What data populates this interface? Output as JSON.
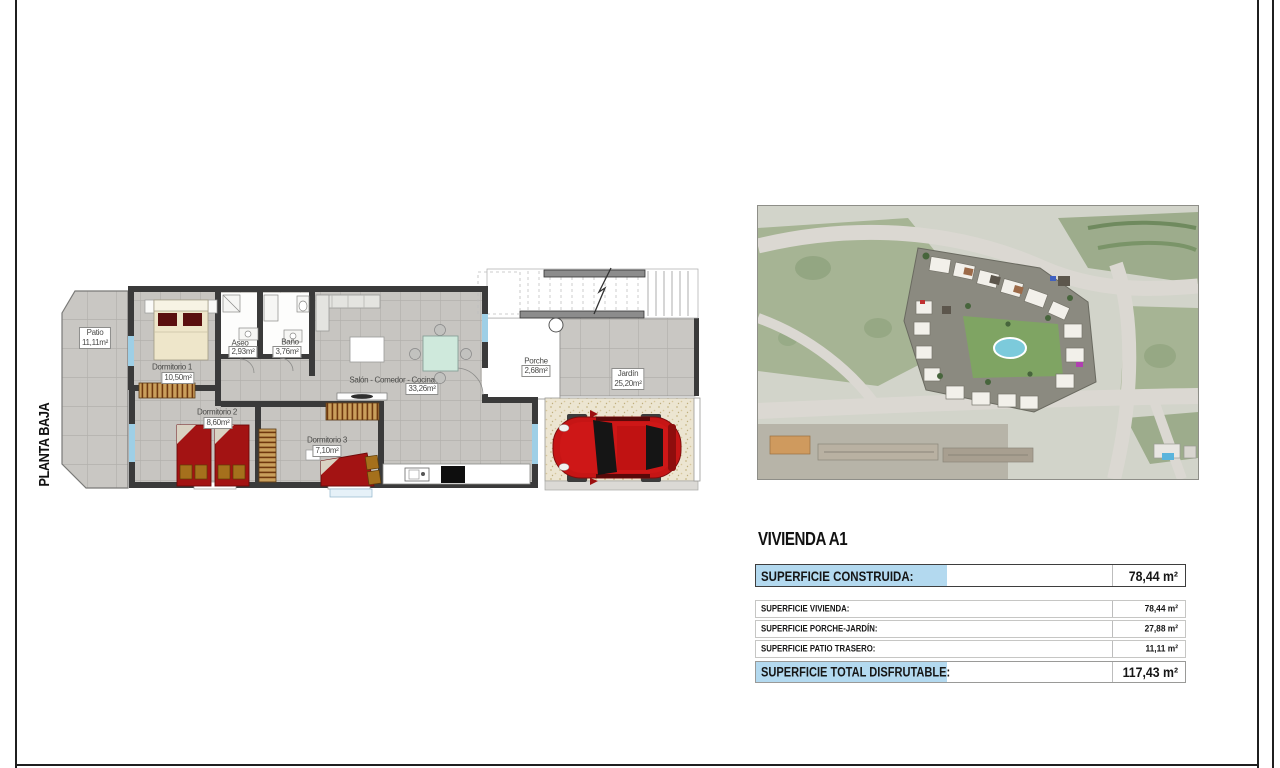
{
  "page": {
    "side_label": "PLANTA BAJA"
  },
  "floor_plan": {
    "rooms": {
      "patio": {
        "name": "Patio",
        "area": "11,11m²"
      },
      "dormitorio_1": {
        "name": "Dormitorio 1",
        "area": "10,50m²"
      },
      "aseo": {
        "name": "Aseo",
        "area": "2,93m²"
      },
      "bano": {
        "name": "Baño",
        "area": "3,76m²"
      },
      "salon": {
        "name": "Salón - Comedor - Cocina",
        "area": "33,26m²"
      },
      "porche": {
        "name": "Porche",
        "area": "2,68m²"
      },
      "jardin": {
        "name": "Jardín",
        "area": "25,20m²"
      },
      "dormitorio_2": {
        "name": "Dormitorio 2",
        "area": "8,60m²"
      },
      "dormitorio_3": {
        "name": "Dormitorio 3",
        "area": "7,10m²"
      }
    }
  },
  "summary": {
    "title": "VIVIENDA A1",
    "construida": {
      "label": "SUPERFICIE CONSTRUIDA:",
      "value": "78,44 m²"
    },
    "vivienda": {
      "label": "SUPERFICIE VIVIENDA:",
      "value": "78,44 m²"
    },
    "porche_jardin": {
      "label": "SUPERFICIE PORCHE-JARDÍN:",
      "value": "27,88 m²"
    },
    "patio_trasero": {
      "label": "SUPERFICIE PATIO TRASERO:",
      "value": "11,11 m²"
    },
    "total": {
      "label": "SUPERFICIE TOTAL DISFRUTABLE:",
      "value": "117,43 m²"
    }
  },
  "colors": {
    "highlight_blue": "#b3d9ef",
    "wall_gray": "#3a3a3a",
    "bed_red": "#a31313",
    "car_red": "#c61515",
    "pool_blue": "#7ccadb",
    "window_blue": "#9ecfe6"
  }
}
